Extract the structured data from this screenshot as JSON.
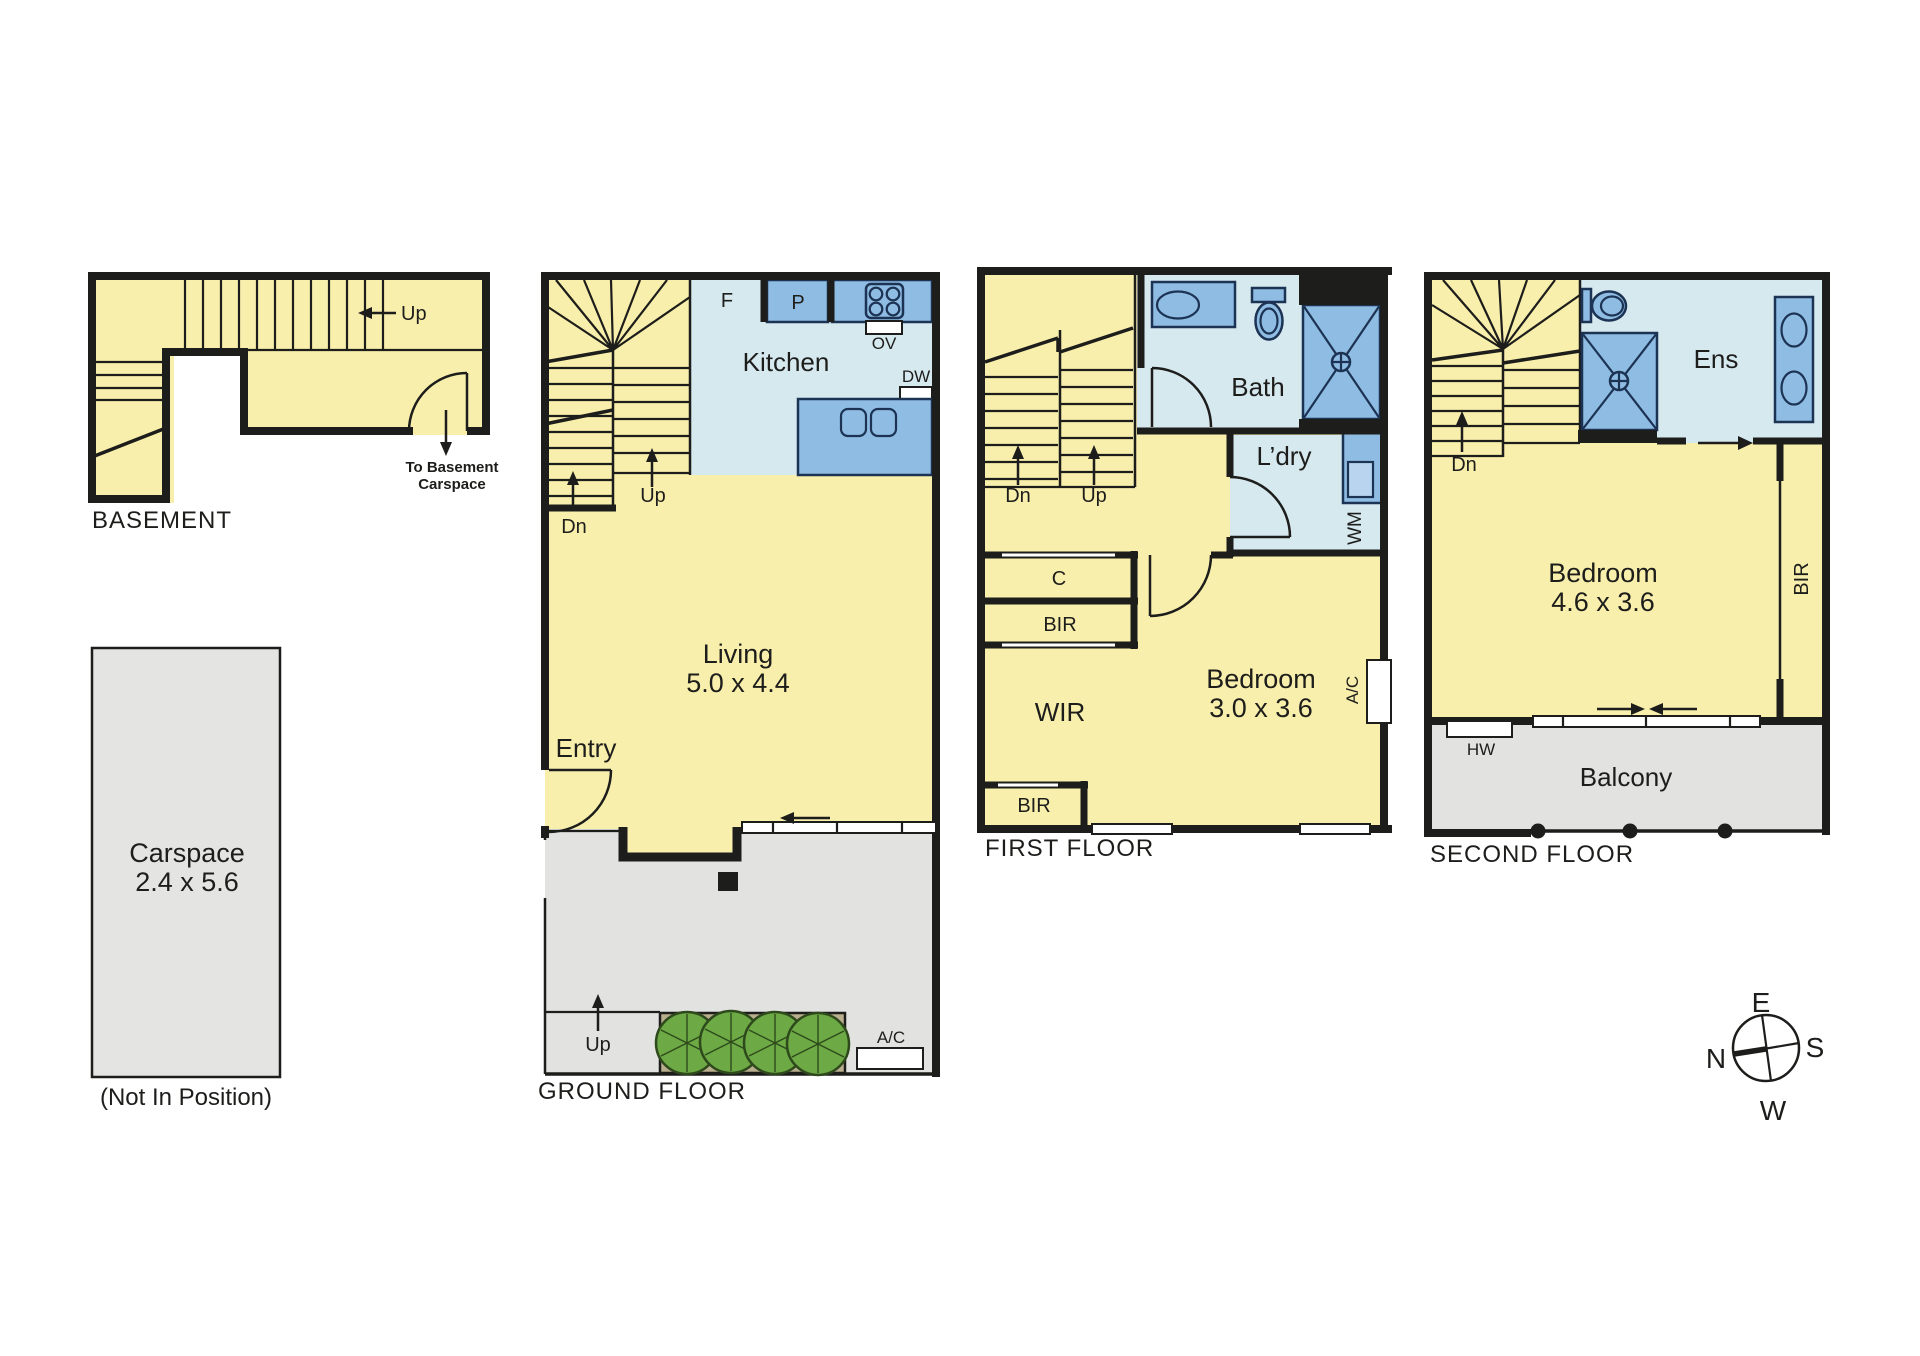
{
  "colors": {
    "wall": "#1D1D1B",
    "room_fill": "#F9EFAC",
    "wet_area_fill": "#D6E9EF",
    "fixture_fill": "#8FBCE3",
    "fixture_outline": "#1C3354",
    "outdoor_fill": "#E2E2E0",
    "garden_bed": "#B9AE8E",
    "tree": "#6DA944"
  },
  "basement": {
    "title": "BASEMENT",
    "up": "Up",
    "exit_line1": "To Basement",
    "exit_line2": "Carspace"
  },
  "ground_floor": {
    "title": "GROUND FLOOR",
    "kitchen_label": "Kitchen",
    "fridge": "F",
    "pantry": "P",
    "oven": "OV",
    "dishwasher": "DW",
    "living_line1": "Living",
    "living_line2": "5.0 x 4.4",
    "entry": "Entry",
    "stair_down": "Dn",
    "stair_up": "Up",
    "courtyard_up": "Up",
    "air_conditioner": "A/C"
  },
  "first_floor": {
    "title": "FIRST FLOOR",
    "bath": "Bath",
    "laundry": "L’dry",
    "washing_machine": "WM",
    "cupboard": "C",
    "robe_top": "BIR",
    "walk_in_robe": "WIR",
    "bedroom_line1": "Bedroom",
    "bedroom_line2": "3.0 x 3.6",
    "air_conditioner": "A/C",
    "robe_bottom": "BIR",
    "stair_down": "Dn",
    "stair_up": "Up"
  },
  "second_floor": {
    "title": "SECOND FLOOR",
    "ensuite": "Ens",
    "bedroom_line1": "Bedroom",
    "bedroom_line2": "4.6 x 3.6",
    "robe": "BIR",
    "hot_water": "HW",
    "balcony": "Balcony",
    "stair_down": "Dn"
  },
  "carspace": {
    "line1": "Carspace",
    "line2": "2.4 x 5.6",
    "note": "(Not In Position)"
  },
  "compass": {
    "north": "N",
    "east": "E",
    "south": "S",
    "west": "W"
  }
}
